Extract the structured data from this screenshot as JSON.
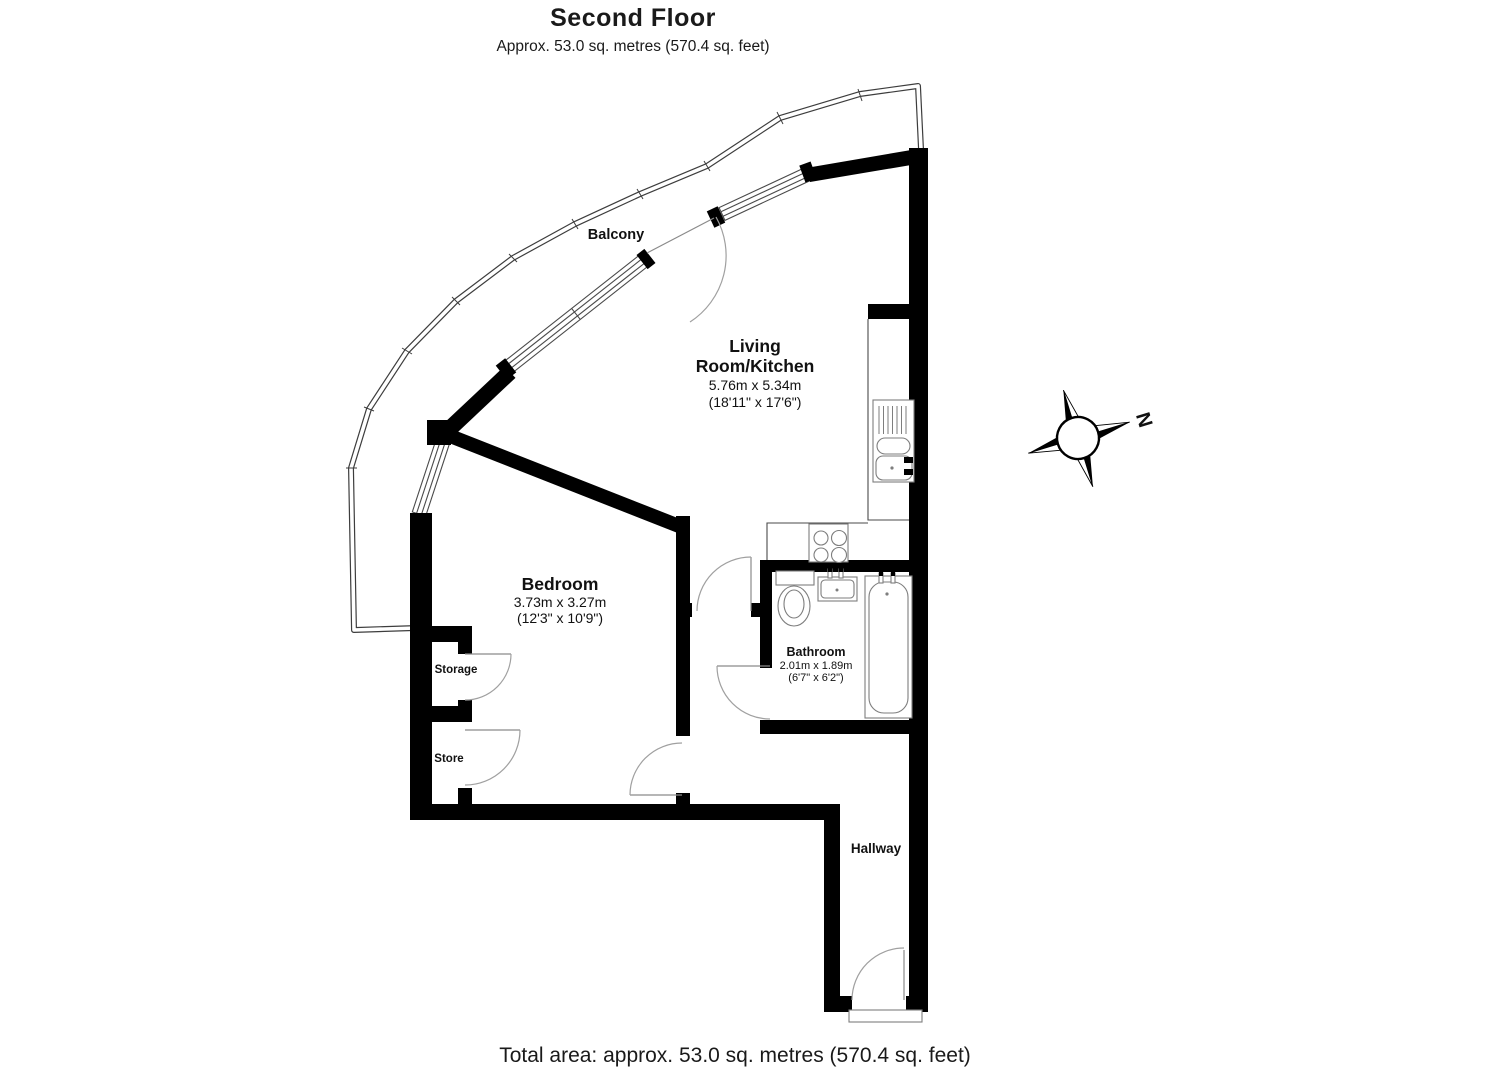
{
  "header": {
    "title": "Second Floor",
    "subtitle": "Approx. 53.0 sq. metres (570.4 sq. feet)"
  },
  "footer": {
    "total_area": "Total area: approx. 53.0 sq. metres (570.4 sq. feet)"
  },
  "compass": {
    "north_label": "N"
  },
  "rooms": {
    "balcony": {
      "name": "Balcony"
    },
    "living_room": {
      "name_line1": "Living",
      "name_line2": "Room/Kitchen",
      "dimensions_metric": "5.76m x 5.34m",
      "dimensions_imperial": "(18'11\" x 17'6\")"
    },
    "bedroom": {
      "name": "Bedroom",
      "dimensions_metric": "3.73m x 3.27m",
      "dimensions_imperial": "(12'3\" x 10'9\")"
    },
    "bathroom": {
      "name": "Bathroom",
      "dimensions_metric": "2.01m x 1.89m",
      "dimensions_imperial": "(6'7\" x 6'2\")"
    },
    "storage": {
      "name": "Storage"
    },
    "store": {
      "name": "Store"
    },
    "hallway": {
      "name": "Hallway"
    }
  },
  "colors": {
    "wall": "#000000",
    "thin_line": "#4a4a4a",
    "door_arc": "#a0a0a0",
    "background": "#ffffff"
  }
}
